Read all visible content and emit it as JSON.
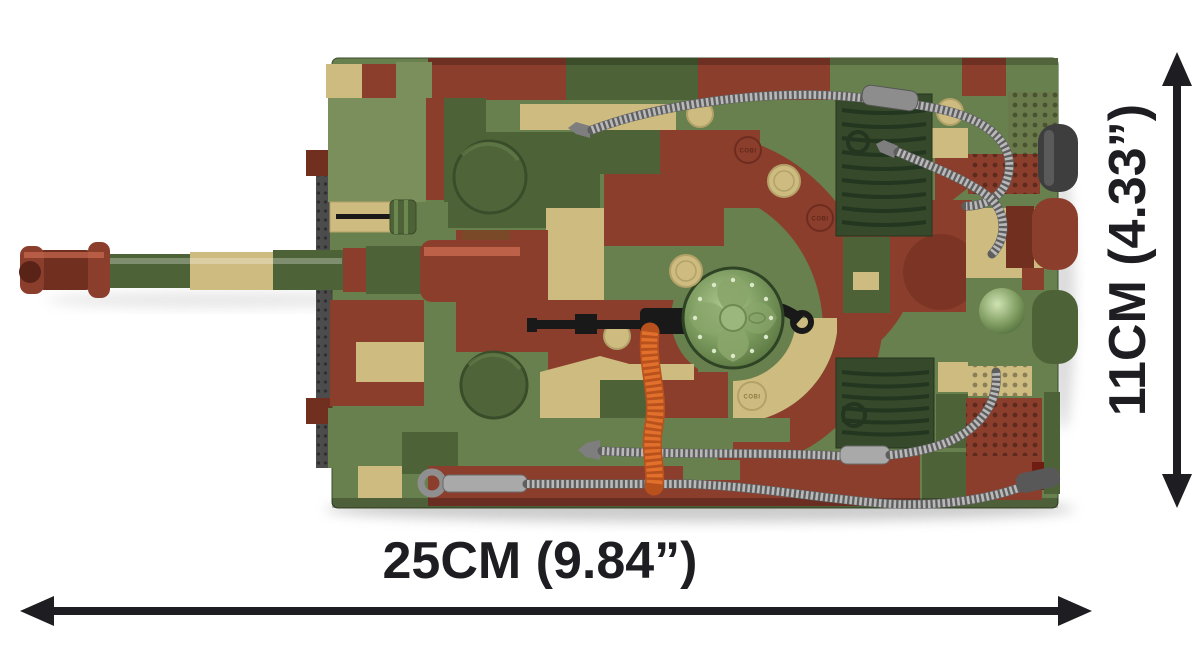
{
  "figure": {
    "subject": "Brick-built camouflage tank model, top view (product dimension photo)",
    "stud_logo": "COBI"
  },
  "dimensions": {
    "width_label": "25CM (9.84”)",
    "height_label": "11CM (4.33”)"
  },
  "colors": {
    "camo_green": "#68804d",
    "camo_green_dark": "#4d6337",
    "grille_green": "#36492a",
    "camo_tan": "#cdbb80",
    "camo_maroon": "#8c3e2c",
    "cable_silver": "#9c9c9c",
    "tow_strip_orange": "#e0702c",
    "annotation_black": "#1d1d22",
    "background": "#ffffff"
  }
}
